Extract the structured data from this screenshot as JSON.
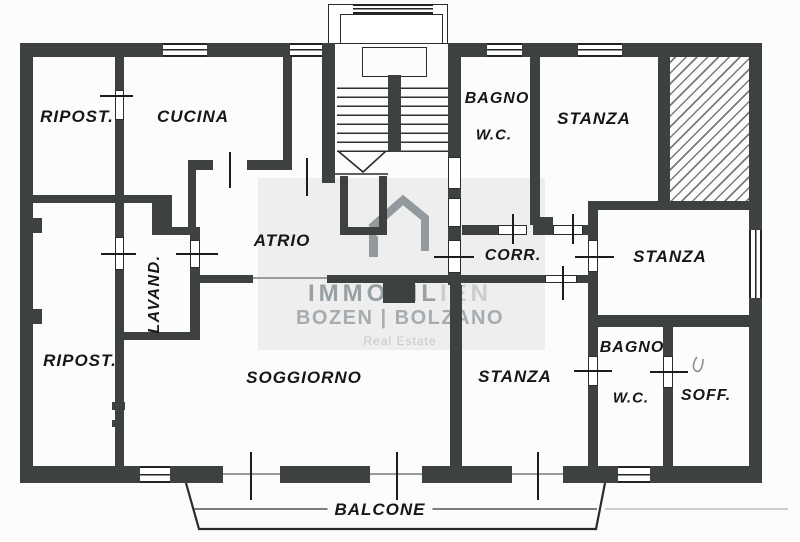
{
  "rooms": {
    "ripost_top": "RIPOST.",
    "cucina": "CUCINA",
    "bagno_top_1": "BAGNO",
    "bagno_top_2": "W.C.",
    "stanza_top": "STANZA",
    "atrio": "ATRIO",
    "lavand": "LAVAND.",
    "corr": "CORR.",
    "stanza_right": "STANZA",
    "ripost_bottom": "RIPOST.",
    "soggiorno": "SOGGIORNO",
    "stanza_bottom": "STANZA",
    "bagno_bottom_1": "BAGNO",
    "bagno_bottom_2": "W.C.",
    "soff": "SOFF.",
    "balcone": "BALCONE"
  },
  "watermark": {
    "brand_dark": "IMMOBIL",
    "brand_light": "IEN",
    "city": "BOZEN | BOLZANO",
    "tagline": "Real Estate",
    "logo_icon": "house-roof-icon"
  },
  "colors": {
    "wall": "#3d4241",
    "line": "#232525",
    "paper": "#fcfcfa",
    "watermark_gray": "#99a0a4",
    "watermark_light": "#c9cdd0",
    "hatch_line": "#5f6463"
  }
}
